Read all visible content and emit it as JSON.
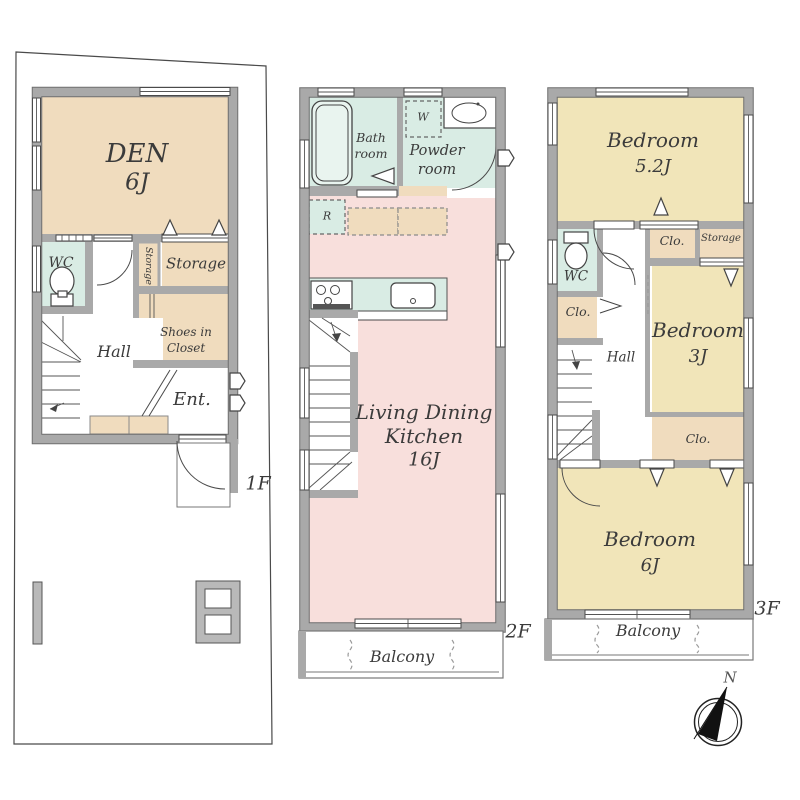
{
  "colors": {
    "wall_gray": "#a9a9a9",
    "room_beige": "#f0dcbe",
    "room_teal": "#d9ece4",
    "room_pink": "#f8dfdc",
    "room_yellow": "#f1e5b9"
  },
  "floor1": {
    "floor_label": "1F",
    "den_name": "DEN",
    "den_size": "6J",
    "wc": "WC",
    "closet_strip": "Storage",
    "storage": "Storage",
    "shoes_closet_line1": "Shoes in",
    "shoes_closet_line2": "Closet",
    "hall": "Hall",
    "entrance": "Ent."
  },
  "floor2": {
    "floor_label": "2F",
    "bath_line1": "Bath",
    "bath_line2": "room",
    "powder_line1": "Powder",
    "powder_line2": "room",
    "washer_mark": "W",
    "fridge_mark": "R",
    "ldk_line1": "Living Dining",
    "ldk_line2": "Kitchen",
    "ldk_size": "16J",
    "balcony": "Balcony"
  },
  "floor3": {
    "floor_label": "3F",
    "bedroom_a_name": "Bedroom",
    "bedroom_a_size": "5.2J",
    "closet_a": "Clo.",
    "storage": "Storage",
    "wc": "WC",
    "closet_b": "Clo.",
    "bedroom_b_name": "Bedroom",
    "bedroom_b_size": "3J",
    "hall": "Hall",
    "closet_c": "Clo.",
    "bedroom_c_name": "Bedroom",
    "bedroom_c_size": "6J",
    "balcony": "Balcony"
  },
  "compass": {
    "north_label": "N"
  }
}
